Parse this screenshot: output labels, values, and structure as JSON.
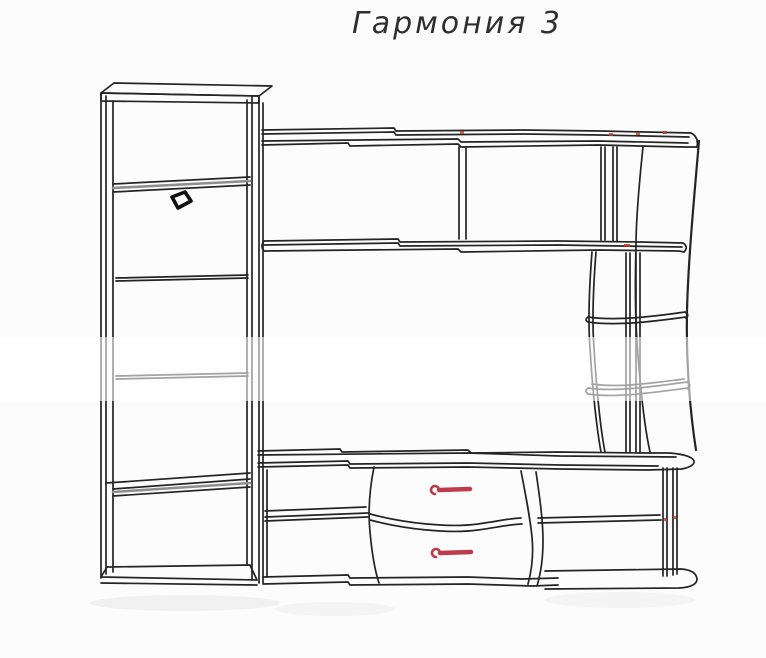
{
  "title": "Гармония 3",
  "colors": {
    "background": "#fcfcfc",
    "line": "#242424",
    "shade_gray": "#8f8f8f",
    "accent_red": "#bf3a4a",
    "title_text": "#2f2f2f"
  },
  "drawing": {
    "type": "furniture-line-sketch",
    "components": [
      "left-cabinet",
      "upper-wall-shelves",
      "curved-side-shelf-unit",
      "tv-stand",
      "drawer-unit"
    ],
    "drawer_count": 2
  }
}
